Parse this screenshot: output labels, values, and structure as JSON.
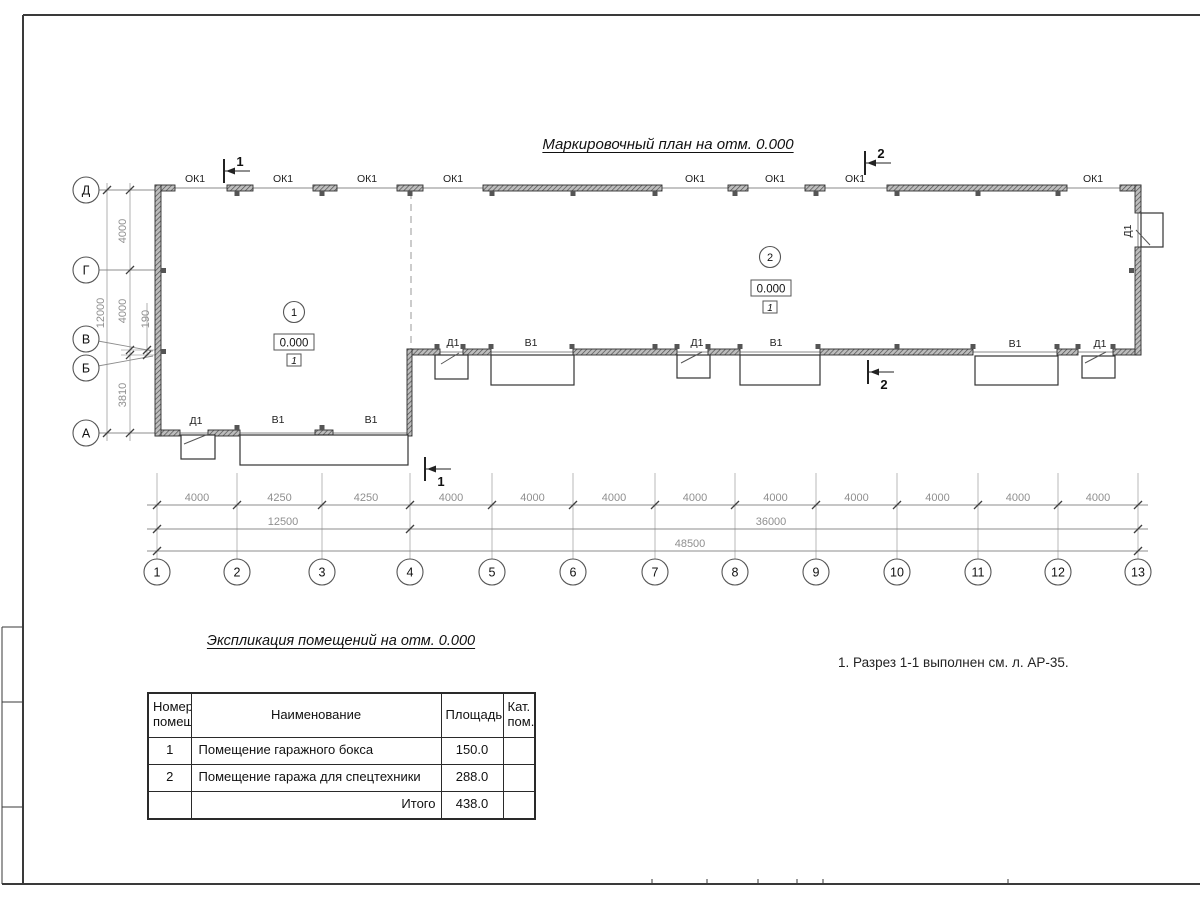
{
  "sheet": {
    "plan_title": "Маркировочный план на отм. 0.000",
    "note": "1. Разрез 1-1 выполнен см. л. АР-35."
  },
  "plan": {
    "labels": {
      "window": "ОК1",
      "door": "Д1",
      "gate": "В1"
    },
    "axes_bottom": [
      "1",
      "2",
      "3",
      "4",
      "5",
      "6",
      "7",
      "8",
      "9",
      "10",
      "11",
      "12",
      "13"
    ],
    "axes_left": [
      "Д",
      "Г",
      "В",
      "Б",
      "А"
    ],
    "dims_row1": [
      "4000",
      "4250",
      "4250",
      "4000",
      "4000",
      "4000",
      "4000",
      "4000",
      "4000",
      "4000",
      "4000",
      "4000"
    ],
    "dims_row2": [
      "12500",
      "36000"
    ],
    "dims_row3": [
      "48500"
    ],
    "dims_left": [
      "4000",
      "4000",
      "190",
      "3810"
    ],
    "dims_left_total": "12000",
    "sections": [
      "1",
      "2"
    ],
    "rooms": [
      {
        "number": "1",
        "elevation": "0.000",
        "mark": "1"
      },
      {
        "number": "2",
        "elevation": "0.000",
        "mark": "1"
      }
    ]
  },
  "table": {
    "title": "Экспликация помещений на отм. 0.000",
    "headers": {
      "num": "Номер помещ.",
      "name": "Наименование",
      "area": "Площадь",
      "cat": "Кат. пом."
    },
    "rows": [
      {
        "num": "1",
        "name": "Помещение гаражного бокса",
        "area": "150.0",
        "cat": ""
      },
      {
        "num": "2",
        "name": "Помещение гаража для спецтехники",
        "area": "288.0",
        "cat": ""
      }
    ],
    "total_label": "Итого",
    "total_area": "438.0"
  }
}
